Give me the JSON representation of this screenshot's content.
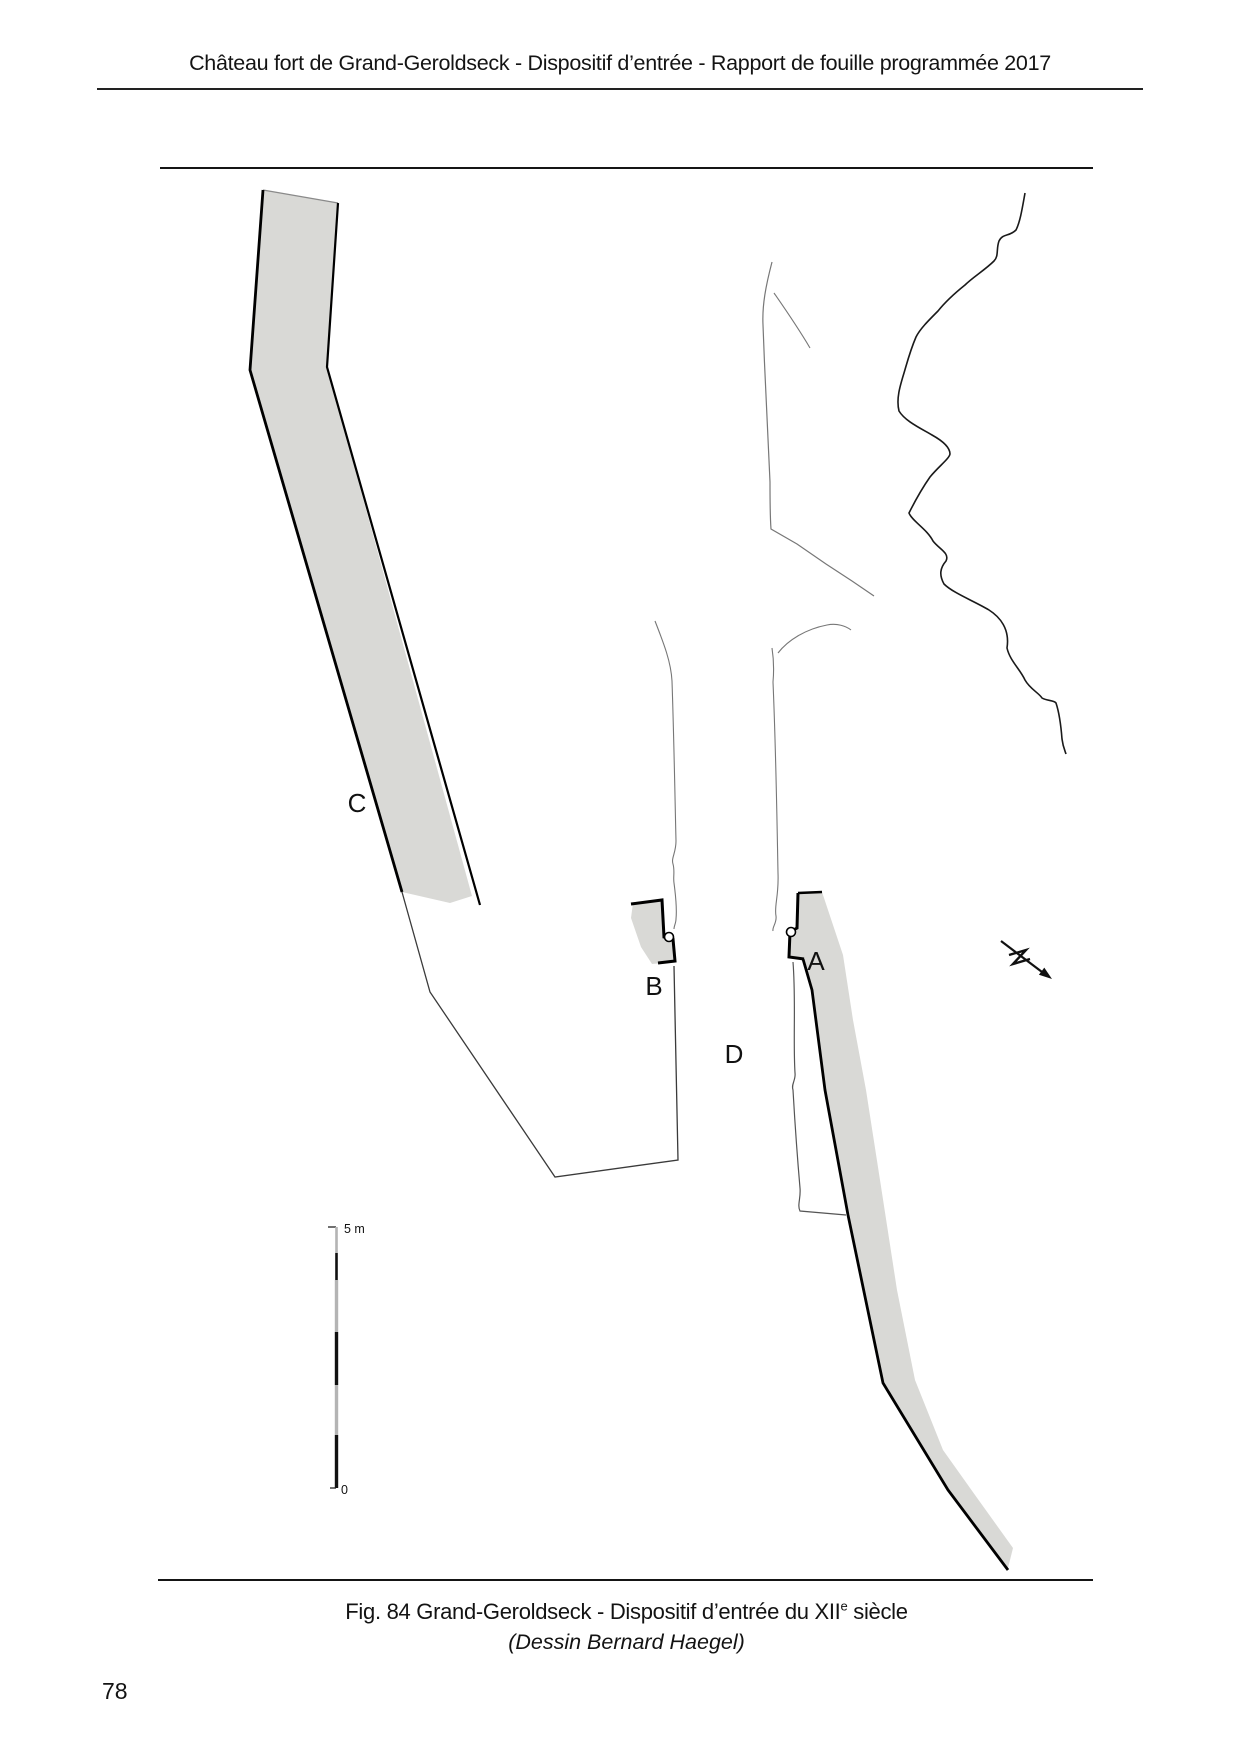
{
  "page": {
    "number": "78"
  },
  "header": {
    "title": "Château fort de Grand-Geroldseck - Dispositif d’entrée - Rapport de fouille programmée 2017"
  },
  "figure": {
    "labels": {
      "a": "A",
      "b": "B",
      "c": "C",
      "d": "D"
    },
    "scale_bar": {
      "top_label": "5 m",
      "bottom_label": "0"
    },
    "caption_line1_prefix": "Fig. 84 Grand-Geroldseck - Dispositif d’entrée du XII",
    "caption_superscript": "e",
    "caption_line1_suffix": " siècle",
    "caption_line2": "(Dessin Bernard Haegel)",
    "colors": {
      "wall_fill": "#d9d9d6",
      "outline": "#000000",
      "thin_line": "#777777",
      "contour": "#1a1a1a",
      "rule": "#222222"
    }
  }
}
